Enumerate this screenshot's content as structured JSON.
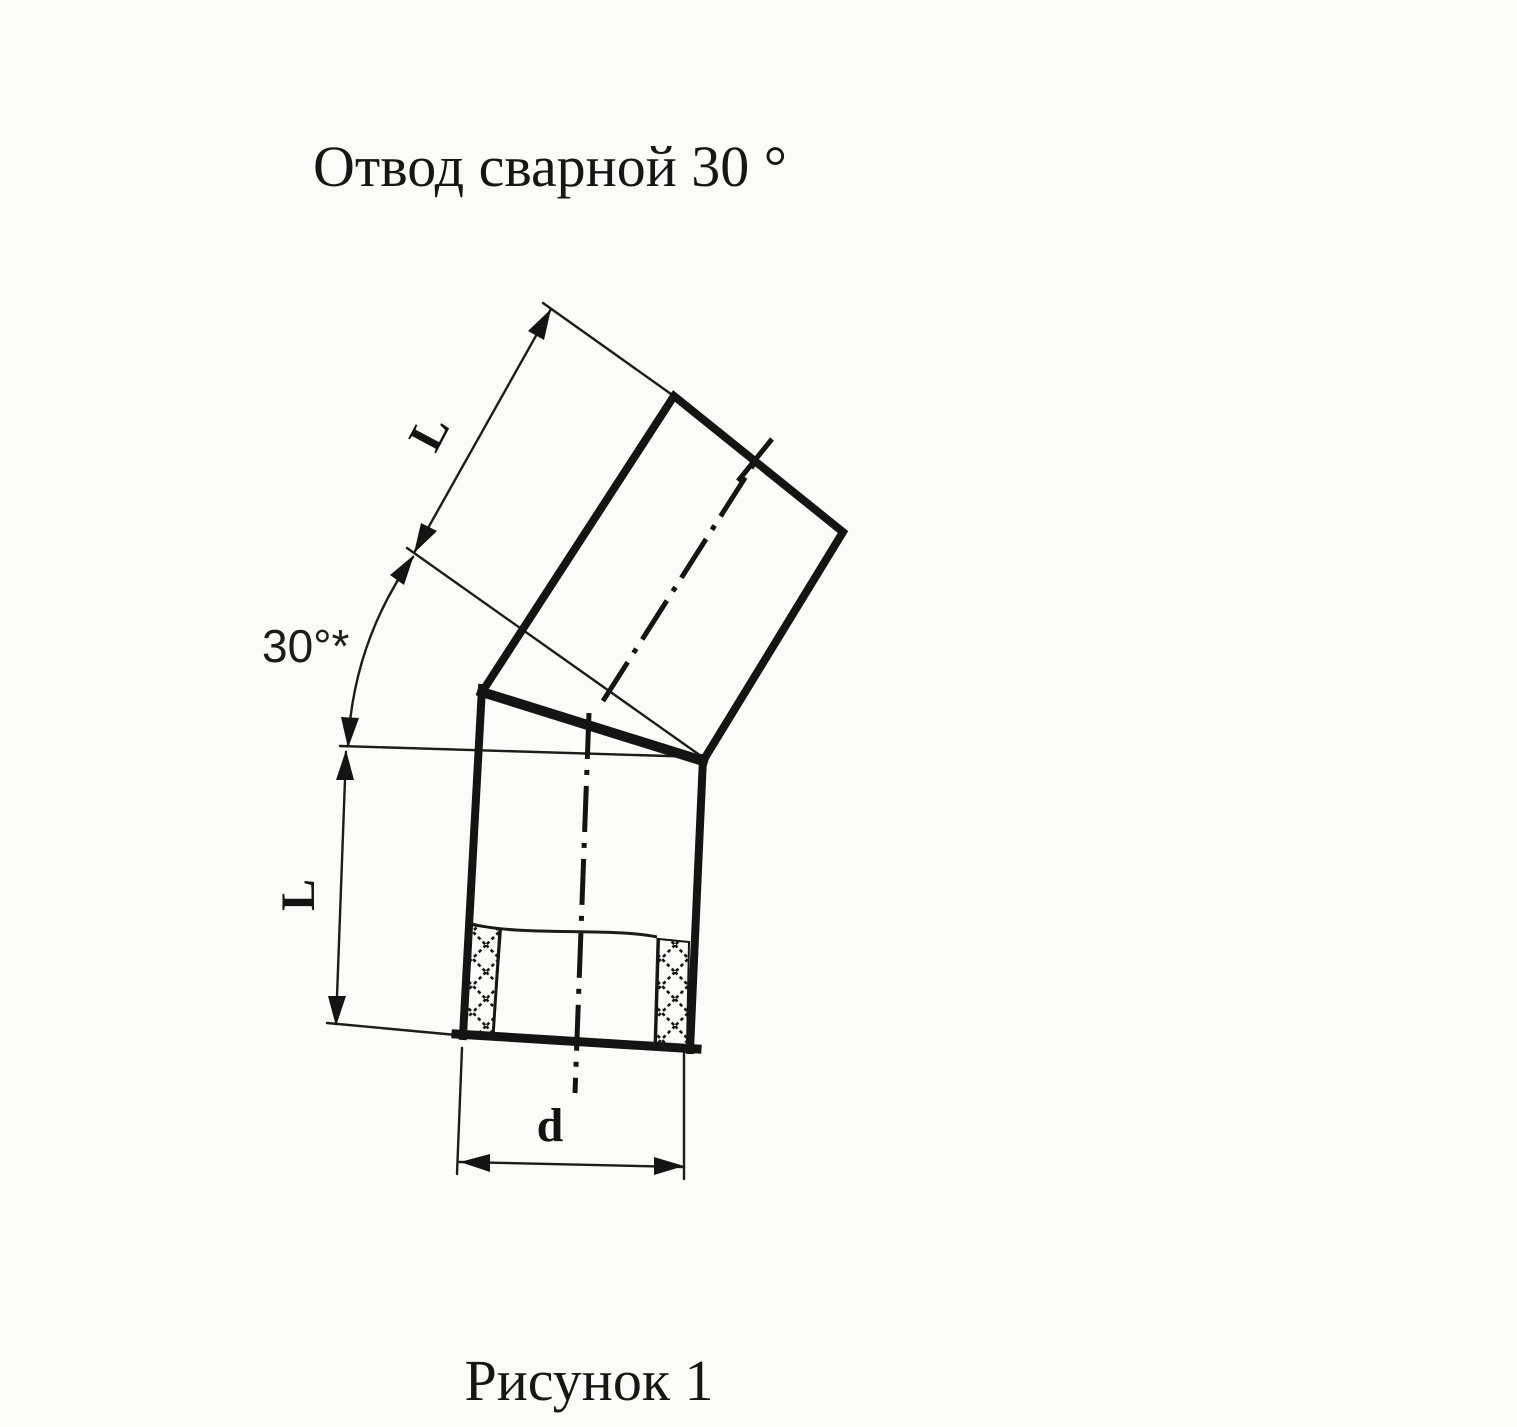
{
  "page": {
    "title": "Отвод сварной 30 °",
    "caption": "Рисунок 1"
  },
  "dimension_labels": {
    "angle": "30°*",
    "upper_segment_length": "L",
    "lower_segment_length": "L",
    "diameter": "d"
  },
  "colors": {
    "ink": "#161616",
    "paper": "#fbfbf9"
  }
}
